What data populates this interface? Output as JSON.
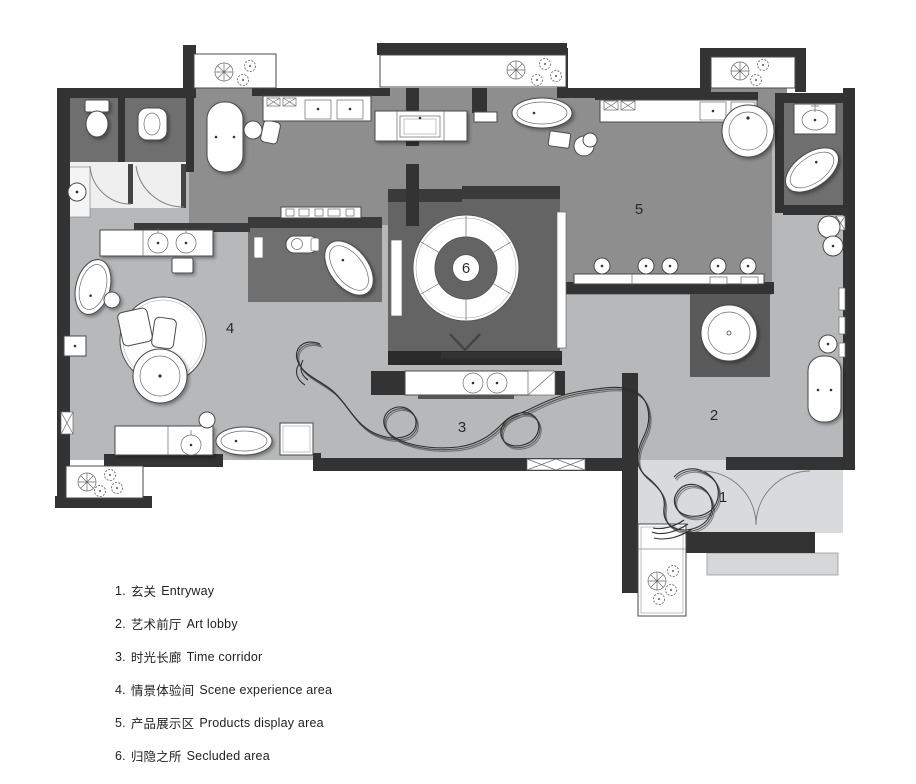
{
  "page": {
    "type": "architectural floor plan of a bathroom-fixture showroom",
    "background": "#ffffff"
  },
  "plan": {
    "area_labels": [
      {
        "id": "area-1",
        "label": "1"
      },
      {
        "id": "area-2",
        "label": "2"
      },
      {
        "id": "area-3",
        "label": "3"
      },
      {
        "id": "area-4",
        "label": "4"
      },
      {
        "id": "area-5",
        "label": "5"
      },
      {
        "id": "area-6",
        "label": "6"
      }
    ],
    "colors": {
      "wall": "#333333",
      "floor_medium": "#8e8e8e",
      "floor_light": "#b6b8b9",
      "floor_pale": "#d9dadb",
      "floor_dark_room": "#6f6f6f",
      "secluded_room_floor": "#646464",
      "fixture_white": "#ffffff",
      "outline": "#4a4a4a"
    }
  },
  "legend": {
    "items": [
      {
        "num": "1.",
        "zh": "玄关",
        "en": "Entryway"
      },
      {
        "num": "2.",
        "zh": "艺术前厅",
        "en": "Art lobby"
      },
      {
        "num": "3.",
        "zh": "时光长廊",
        "en": "Time corridor"
      },
      {
        "num": "4.",
        "zh": "情景体验间",
        "en": "Scene experience area"
      },
      {
        "num": "5.",
        "zh": "产品展示区",
        "en": "Products display area"
      },
      {
        "num": "6.",
        "zh": "归隐之所",
        "en": "Secluded area"
      }
    ]
  }
}
